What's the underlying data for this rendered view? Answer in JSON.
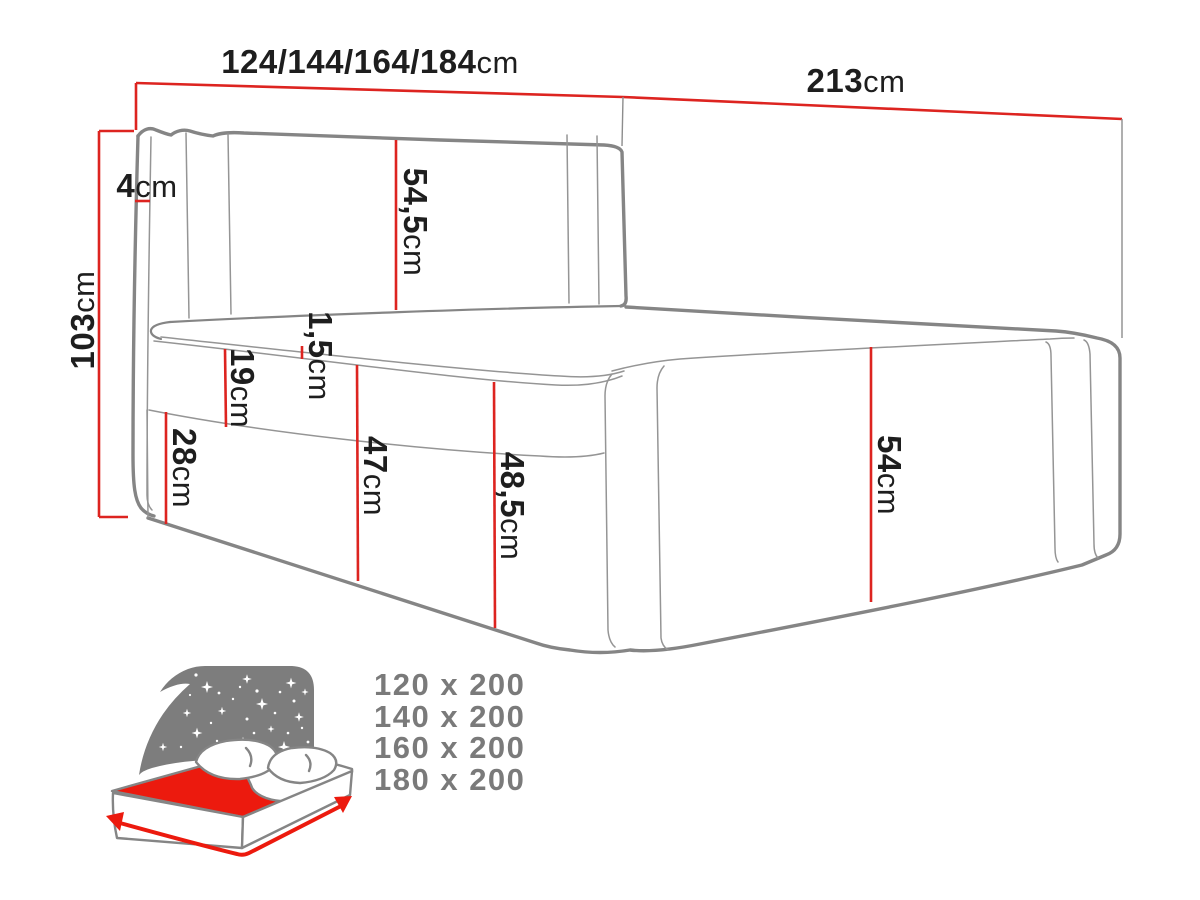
{
  "dimensions": {
    "width": {
      "value": "124/144/164/184",
      "unit": "cm"
    },
    "length": {
      "value": "213",
      "unit": "cm"
    },
    "total_height": {
      "value": "103",
      "unit": "cm"
    },
    "headboard_wing": {
      "value": "4",
      "unit": "cm"
    },
    "headboard_front": {
      "value": "54,5",
      "unit": "cm"
    },
    "mattress_edge": {
      "value": "1,5",
      "unit": "cm"
    },
    "mattress_height": {
      "value": "19",
      "unit": "cm"
    },
    "base_height": {
      "value": "28",
      "unit": "cm"
    },
    "front_height_mid": {
      "value": "47",
      "unit": "cm"
    },
    "front_height_corner": {
      "value": "48,5",
      "unit": "cm"
    },
    "side_height_foot": {
      "value": "54",
      "unit": "cm"
    }
  },
  "available_sizes": {
    "items": [
      "120 x 200",
      "140 x 200",
      "160 x 200",
      "180 x 200"
    ]
  },
  "icon": {
    "name": "bed-size-icon"
  },
  "colors": {
    "dimension_red": "#dd2420",
    "outline_gray": "#858585",
    "label_black": "#1e1e1e",
    "sizes_gray": "#7a7a7a",
    "icon_red": "#ec1a0e",
    "icon_sky_gray": "#7d7d7d"
  }
}
